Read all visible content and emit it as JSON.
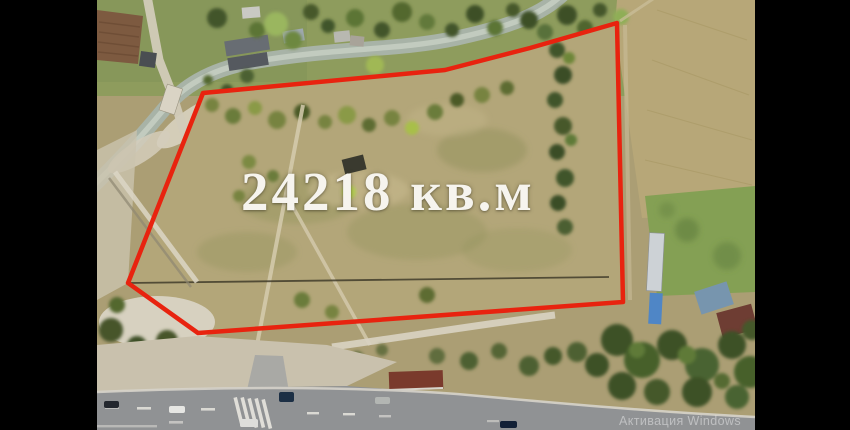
{
  "frame": {
    "area_label": "24218 кв.м",
    "watermark": "Активация Windows",
    "colors": {
      "boundary_red": "#e8230f",
      "label_white": "#f6f4ee",
      "letterbox_black": "#000000"
    }
  }
}
